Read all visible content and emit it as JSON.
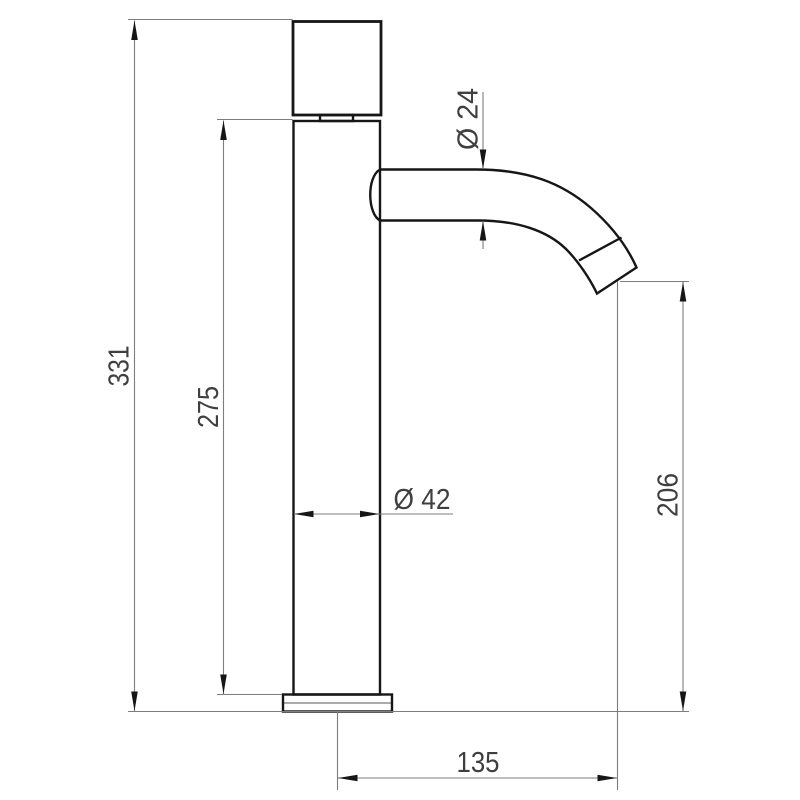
{
  "drawing": {
    "labels": {
      "overall_height": "331",
      "column_height": "275",
      "column_diameter": "Ø 42",
      "spout_diameter": "Ø 24",
      "outlet_height": "206",
      "spout_reach": "135"
    },
    "colors": {
      "outline": "#161616",
      "dimension_line": "#7d7d7d",
      "dimension_text": "#3f3f3f",
      "background": "#ffffff"
    }
  }
}
